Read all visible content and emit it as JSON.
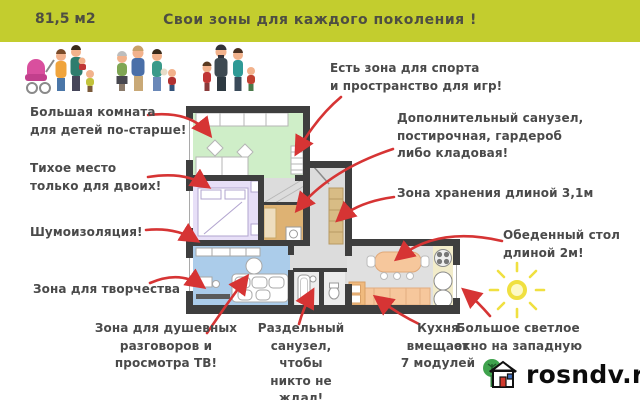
{
  "header": {
    "area_label": "81,5 м2",
    "title": "Свои зоны для каждого поколения !"
  },
  "annotations": {
    "big_room": "Большая комната\nдля детей по-старше!",
    "quiet_place": "Тихое место\nтолько для двоих!",
    "soundproofing": "Шумоизоляция!",
    "creative_zone": "Зона для творчества",
    "tv_zone": "Зона для душевных\nразговоров и\nпросмотра ТВ!",
    "sport_zone": "Есть зона для спорта\nи пространство для игр!",
    "extra_bathroom": "Дополнительный санузел,\nпостирочная, гардероб\nлибо кладовая!",
    "storage_zone": "Зона хранения длиной 3,1м",
    "dining_table": "Обеденный стол\nдлиной 2м!",
    "bright_window": "Большое светлое\nокно на западную",
    "separate_bathroom": "Раздельный\nсанузел, чтобы\nникто не ждал!",
    "kitchen_modules": "Кухня\nвмещает\n7 модулей"
  },
  "watermark": {
    "site": "rosndv.ru"
  },
  "icons": [
    "family-icons",
    "sun-icon",
    "house-logo-icon",
    "red-arrow"
  ],
  "colors": {
    "header_bg": "#c3cd2e",
    "annotation_text": "#4a4a4a",
    "arrow_red": "#d63434",
    "wall": "#3e3e3e",
    "room_children_green": "#cfeec8",
    "room_bedroom_purple": "#e7dff7",
    "room_living_blue": "#abccea",
    "room_laundry_orange": "#deb273",
    "corridor_gray": "#dcdcdc",
    "furniture_orange": "#f6c79c",
    "storage_tan": "#d8bc85",
    "sun_yellow": "#f0e040"
  }
}
